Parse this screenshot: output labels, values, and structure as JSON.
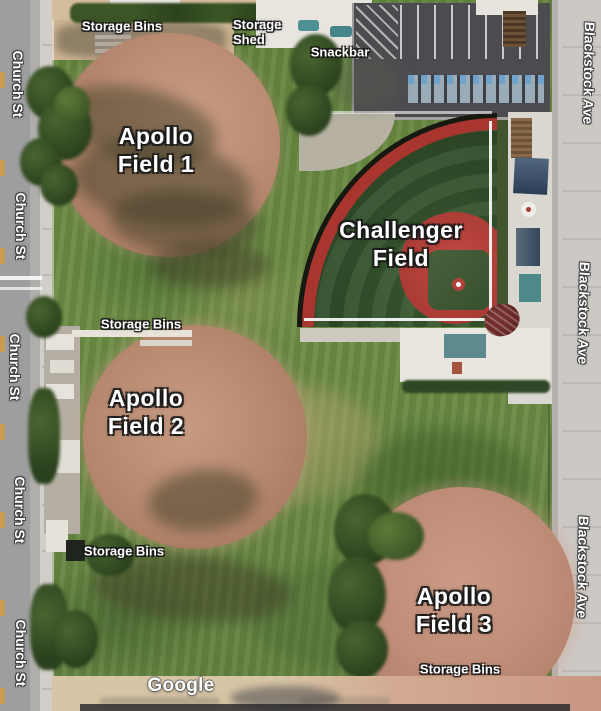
{
  "map": {
    "attribution": "Google",
    "streets": {
      "left_name": "Church St",
      "right_name": "Blackstock Ave"
    },
    "labels": {
      "storage_bins": "Storage Bins",
      "storage_shed_line1": "Storage",
      "storage_shed_line2": "Shed",
      "snackbar": "Snackbar"
    },
    "fields": {
      "apollo1_line1": "Apollo",
      "apollo1_line2": "Field 1",
      "apollo2_line1": "Apollo",
      "apollo2_line2": "Field 2",
      "apollo3_line1": "Apollo",
      "apollo3_line2": "Field 3",
      "challenger_line1": "Challenger",
      "challenger_line2": "Field"
    },
    "colors": {
      "grass": "#6a8a42",
      "infield_dirt": "#bb8d74",
      "challenger_turf": "#35522e",
      "challenger_red": "#b0423a",
      "parking_asphalt": "#4c4c50",
      "road_gray": "#c8c7c4",
      "label_text": "#ffffff"
    }
  }
}
